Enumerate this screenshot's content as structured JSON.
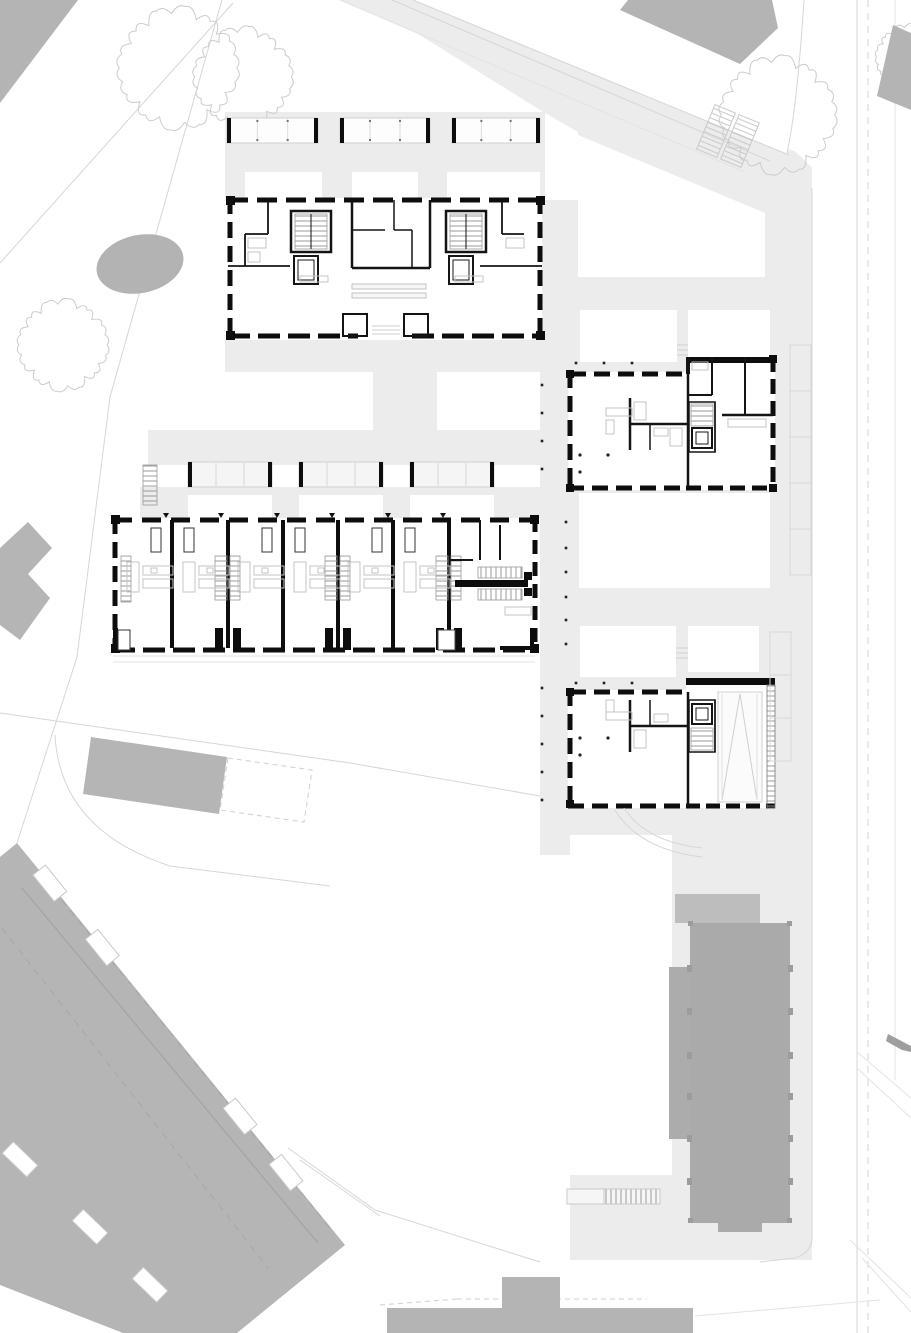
{
  "meta": {
    "title": "residential quarter site plan - ground floor",
    "drawing_type": "architectural site / floor plan",
    "orientation": "street on east side"
  },
  "palette": {
    "paper": "#ffffff",
    "paving": "#ececec",
    "context_building": "#b4b4b4",
    "context_building_light": "#bdbdbd",
    "tower": "#aaaaaa",
    "tower_trim": "#9c9c9c",
    "southwest_mass": "#b5b5b5",
    "pond": "#b3b3b3",
    "wall": "#0d0d0d",
    "furniture_line": "#c4c4c4",
    "site_line": "#d6d6d6",
    "tree_line": "#cccccc",
    "hatch_line": "#909090",
    "dot": "#222222"
  },
  "landscape": {
    "pond": {
      "cx": 140,
      "cy": 264,
      "rx": 44,
      "ry": 29,
      "rotate": -12
    },
    "trees": [
      [
        178,
        68,
        56
      ],
      [
        243,
        77,
        46
      ],
      [
        63,
        345,
        42
      ],
      [
        778,
        115,
        54
      ],
      [
        908,
        57,
        30
      ]
    ]
  },
  "roads": {
    "street_right": {
      "solid_x": 857,
      "dashed_x": 868,
      "faint_x": 895
    },
    "crosswalk": {
      "cx": 728,
      "cy": 136,
      "angle": 22.5
    }
  },
  "parking": [
    {
      "x": 790,
      "y": 345,
      "w": 21,
      "h": 46,
      "n": 5
    },
    {
      "x": 770,
      "y": 632,
      "w": 21,
      "h": 43,
      "n": 3
    }
  ],
  "plans": {
    "north_apartment_building": {
      "label": "north apartment building, two stair cores",
      "balconies": {
        "y": 118,
        "h": 25,
        "xs": [
          227,
          340,
          452
        ],
        "ws": [
          91,
          90,
          88
        ]
      }
    },
    "row_houses": {
      "label": "row house terrace, 6 units + common entry bay",
      "left": 113,
      "right": 535,
      "top": 518,
      "bottom": 652,
      "party_walls": [
        172,
        228,
        283,
        338,
        393,
        449
      ],
      "stair_walls": [
        228,
        338,
        449
      ],
      "wardrobe_walls": [
        172,
        283,
        393
      ],
      "unit_starts": [
        121,
        177,
        232,
        288,
        342,
        398
      ],
      "entry_marks": [
        166,
        221,
        277,
        332,
        388,
        443
      ],
      "pergolas": {
        "y": 462,
        "h": 25,
        "w": 84,
        "xs": [
          188,
          299,
          410
        ]
      }
    },
    "east_house_north": {
      "label": "east apartment house with stair and lift"
    },
    "east_house_south": {
      "label": "east apartment house with ramp hall"
    }
  },
  "context": {
    "tower": {
      "pilaster_ys": [
        965,
        1008,
        1052,
        1093,
        1135,
        1178
      ],
      "side_xs": [
        687,
        788
      ]
    },
    "southwest_mass": {
      "upper_balconies": {
        "ax": 17,
        "ay": 843,
        "bx": 345,
        "by": 1245,
        "ts": [
          0.1,
          0.26,
          0.68,
          0.82
        ],
        "w": 34,
        "h": 16,
        "angle": 51
      },
      "lower_balconies": {
        "ax": 0,
        "ay": 1140,
        "bx": 200,
        "by": 1333,
        "ts": [
          0.1,
          0.45,
          0.75
        ],
        "w": 34,
        "h": 16,
        "angle": 44
      }
    }
  },
  "dots": [
    [
      542,
      385
    ],
    [
      542,
      413
    ],
    [
      542,
      441
    ],
    [
      542,
      469
    ],
    [
      566,
      522
    ],
    [
      566,
      548
    ],
    [
      566,
      572
    ],
    [
      566,
      597
    ],
    [
      566,
      620
    ],
    [
      566,
      644
    ],
    [
      542,
      688
    ],
    [
      542,
      716
    ],
    [
      542,
      744
    ],
    [
      542,
      772
    ],
    [
      542,
      800
    ],
    [
      576,
      363
    ],
    [
      604,
      363
    ],
    [
      632,
      363
    ],
    [
      576,
      683
    ],
    [
      604,
      683
    ],
    [
      632,
      683
    ]
  ]
}
